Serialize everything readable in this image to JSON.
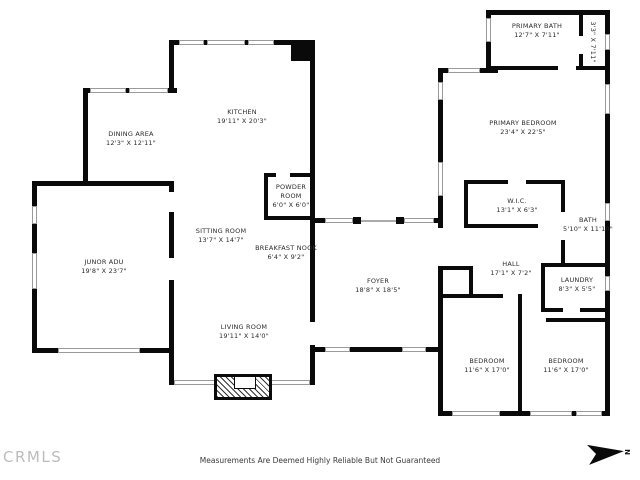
{
  "footer": {
    "disclaimer": "Measurements Are Deemed Highly Reliable But Not Guaranteed",
    "brand": "CRMLS",
    "north_label": "N"
  },
  "colors": {
    "wall": "#0a0a0a",
    "window_line": "#9a9a9a",
    "brand_gray": "#bcbcbc"
  },
  "rooms": [
    {
      "id": "kitchen",
      "name": "KITCHEN",
      "dims": "19'11\" X 20'3\""
    },
    {
      "id": "dining-area",
      "name": "DINING AREA",
      "dims": "12'3\" X 12'11\""
    },
    {
      "id": "powder-room",
      "name": "POWDER ROOM",
      "dims": "6'0\" X 6'0\""
    },
    {
      "id": "sitting-room",
      "name": "SITTING ROOM",
      "dims": "13'7\" X 14'7\""
    },
    {
      "id": "breakfast-nook",
      "name": "BREAKFAST NOOK",
      "dims": "6'4\" X 9'2\""
    },
    {
      "id": "junor-adu",
      "name": "JUNOR ADU",
      "dims": "19'8\" X 23'7\""
    },
    {
      "id": "living-room",
      "name": "LIVING ROOM",
      "dims": "19'11\" X 14'0\""
    },
    {
      "id": "foyer",
      "name": "FOYER",
      "dims": "18'8\" X 18'5\""
    },
    {
      "id": "primary-bath",
      "name": "PRIMARY BATH",
      "dims": "12'7\" X 7'11\""
    },
    {
      "id": "primary-closet",
      "name": "",
      "dims": "3'3\" X 7'11\""
    },
    {
      "id": "primary-bedroom",
      "name": "PRIMARY BEDROOM",
      "dims": "23'4\" X 22'5\""
    },
    {
      "id": "wic",
      "name": "W.I.C.",
      "dims": "13'1\" X 6'3\""
    },
    {
      "id": "bath",
      "name": "BATH",
      "dims": "5'10\" X 11'10\""
    },
    {
      "id": "hall",
      "name": "HALL",
      "dims": "17'1\" X 7'2\""
    },
    {
      "id": "laundry",
      "name": "LAUNDRY",
      "dims": "8'3\" X 5'5\""
    },
    {
      "id": "bedroom-left",
      "name": "BEDROOM",
      "dims": "11'6\" X 17'0\""
    },
    {
      "id": "bedroom-right",
      "name": "BEDROOM",
      "dims": "11'6\" X 17'0\""
    }
  ]
}
